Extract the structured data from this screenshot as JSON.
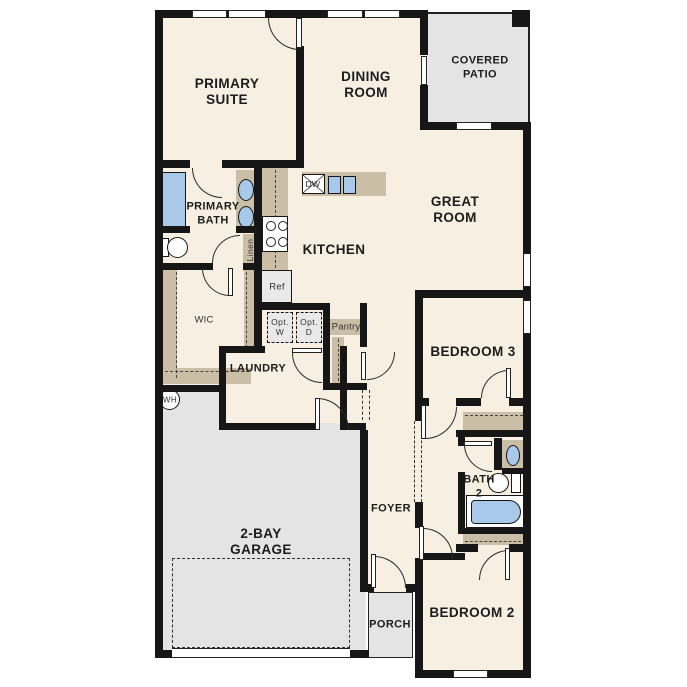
{
  "rooms": {
    "primary_suite": {
      "lines": [
        "PRIMARY",
        "SUITE"
      ]
    },
    "dining_room": {
      "lines": [
        "DINING",
        "ROOM"
      ]
    },
    "covered_patio": {
      "lines": [
        "COVERED",
        "PATIO"
      ]
    },
    "great_room": {
      "lines": [
        "GREAT",
        "ROOM"
      ]
    },
    "primary_bath": {
      "lines": [
        "PRIMARY",
        "BATH"
      ]
    },
    "wic": {
      "lines": [
        "WIC"
      ]
    },
    "kitchen": {
      "lines": [
        "KITCHEN"
      ]
    },
    "laundry": {
      "lines": [
        "LAUNDRY"
      ]
    },
    "pantry": {
      "lines": [
        "Pantry"
      ]
    },
    "foyer": {
      "lines": [
        "FOYER"
      ]
    },
    "garage": {
      "lines": [
        "2-BAY",
        "GARAGE"
      ]
    },
    "porch": {
      "lines": [
        "PORCH"
      ]
    },
    "bedroom2": {
      "lines": [
        "BEDROOM 2"
      ]
    },
    "bedroom3": {
      "lines": [
        "BEDROOM 3"
      ]
    },
    "bath2": {
      "lines": [
        "BATH",
        "2"
      ]
    }
  },
  "fixtures": {
    "ref": "Ref",
    "dw": "DW",
    "linen": "Linen",
    "wh": "WH",
    "opt_washer": {
      "lines": [
        "Opt.",
        "W"
      ]
    },
    "opt_dryer": {
      "lines": [
        "Opt.",
        "D"
      ]
    }
  },
  "colors": {
    "floor": "#f7f0e2",
    "wall": "#161616",
    "counter_tan": "#cbbea6",
    "fixture_blue": "#a9c9ea",
    "concrete_gray": "#e4e4e4",
    "appliance_gray": "#e9e9e9",
    "background": "#ffffff"
  }
}
